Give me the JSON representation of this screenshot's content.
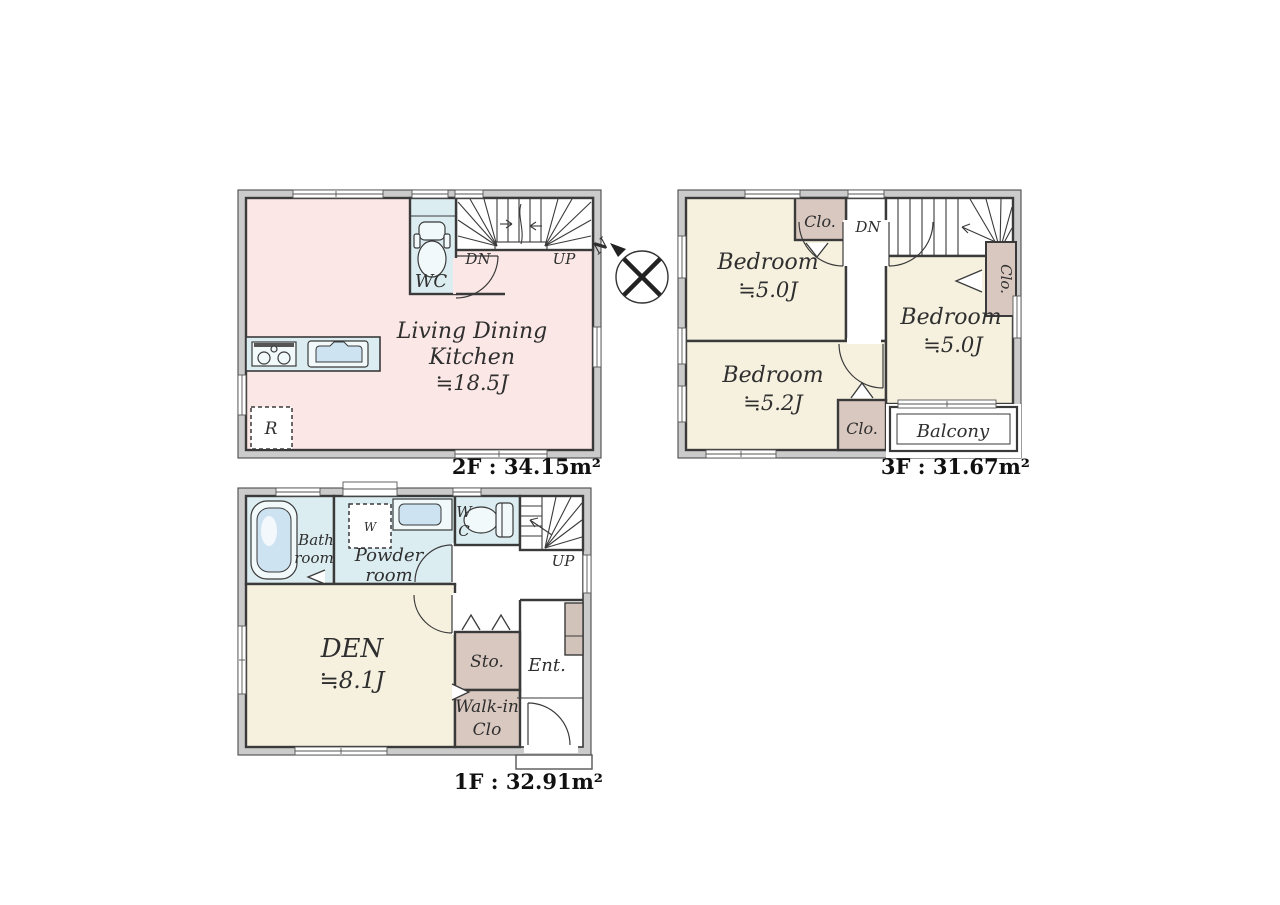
{
  "colors": {
    "wall_fill": "#cbcbcb",
    "wall_line": "#3a3a3a",
    "ldk_floor": "#fbe8e6",
    "bedroom_floor": "#f6f1df",
    "wet_room_floor": "#dcedf2",
    "closet_fill": "#d9c8c0",
    "text": "#2f2f2f"
  },
  "compass": {
    "north": "N"
  },
  "floor_2f": {
    "area_label": "2F : 34.15m²",
    "ldk_name_line1": "Living Dining",
    "ldk_name_line2": "Kitchen",
    "ldk_size": "≒18.5J",
    "wc_label": "WC",
    "stair_down": "DN",
    "stair_up": "UP",
    "refrigerator": "R"
  },
  "floor_3f": {
    "area_label": "3F : 31.67m²",
    "stair_down": "DN",
    "bedroom_nw_name": "Bedroom",
    "bedroom_nw_size": "≒5.0J",
    "bedroom_sw_name": "Bedroom",
    "bedroom_sw_size": "≒5.2J",
    "bedroom_e_name": "Bedroom",
    "bedroom_e_size": "≒5.0J",
    "closet_top_label": "Clo.",
    "closet_right_label": "Clo.",
    "closet_bottom_label": "Clo.",
    "balcony_label": "Balcony"
  },
  "floor_1f": {
    "area_label": "1F : 32.91m²",
    "bath_line1": "Bath",
    "bath_line2": "room",
    "powder_line1": "Powder",
    "powder_line2": "room",
    "washer_label": "W",
    "wc_line1": "W",
    "wc_line2": "C",
    "stair_up": "UP",
    "den_name": "DEN",
    "den_size": "≒8.1J",
    "storage_label": "Sto.",
    "walkin_line1": "Walk-in",
    "walkin_line2": "Clo",
    "entrance_label": "Ent."
  }
}
